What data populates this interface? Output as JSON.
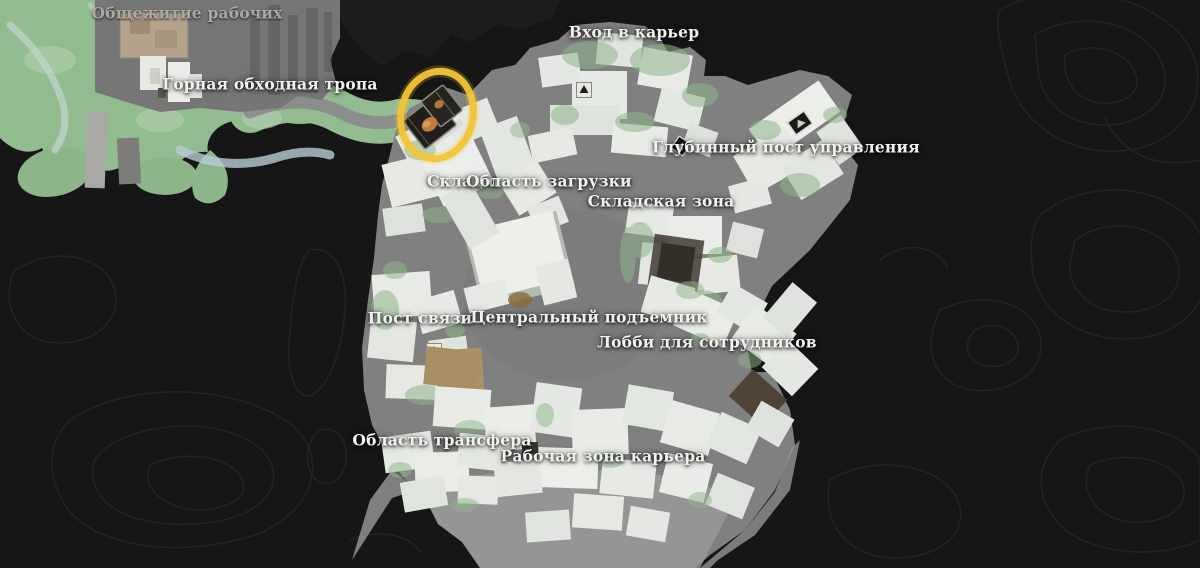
{
  "map": {
    "title": "quarry-area-game-map",
    "labels": [
      {
        "id": "workers-dormitory",
        "text": "Общежитие рабочих"
      },
      {
        "id": "mountain-bypass-trail",
        "text": "Горная обходная тропа"
      },
      {
        "id": "quarry-entrance",
        "text": "Вход в карьер"
      },
      {
        "id": "deep-control-post",
        "text": "Глубинный пост управления"
      },
      {
        "id": "warehouse-partial",
        "text": "Склад о"
      },
      {
        "id": "loading-area",
        "text": "Область загрузки"
      },
      {
        "id": "storage-zone",
        "text": "Складская зона"
      },
      {
        "id": "communication-post",
        "text": "Пост связи"
      },
      {
        "id": "central-elevator",
        "text": "Центральный подъемник"
      },
      {
        "id": "employee-lobby",
        "text": "Лобби для сотрудников"
      },
      {
        "id": "transfer-area",
        "text": "Область трансфера"
      },
      {
        "id": "quarry-work-zone",
        "text": "Рабочая зона карьера"
      }
    ],
    "highlight": {
      "name": "collectible-highlight-ring",
      "item_icon": "record-collectible-icon",
      "color": "#F2C437"
    },
    "markers": [
      {
        "name": "gate-marker-north"
      },
      {
        "name": "gate-marker-northeast"
      },
      {
        "name": "gate-marker-control-post"
      },
      {
        "name": "gate-marker-west"
      }
    ],
    "colors": {
      "background": "#161616",
      "contour": "#262626",
      "map_gray": "#808080",
      "terrain_green": "#93bb90",
      "building": "#e8ebe6",
      "accent_yellow": "#F2C437"
    }
  }
}
